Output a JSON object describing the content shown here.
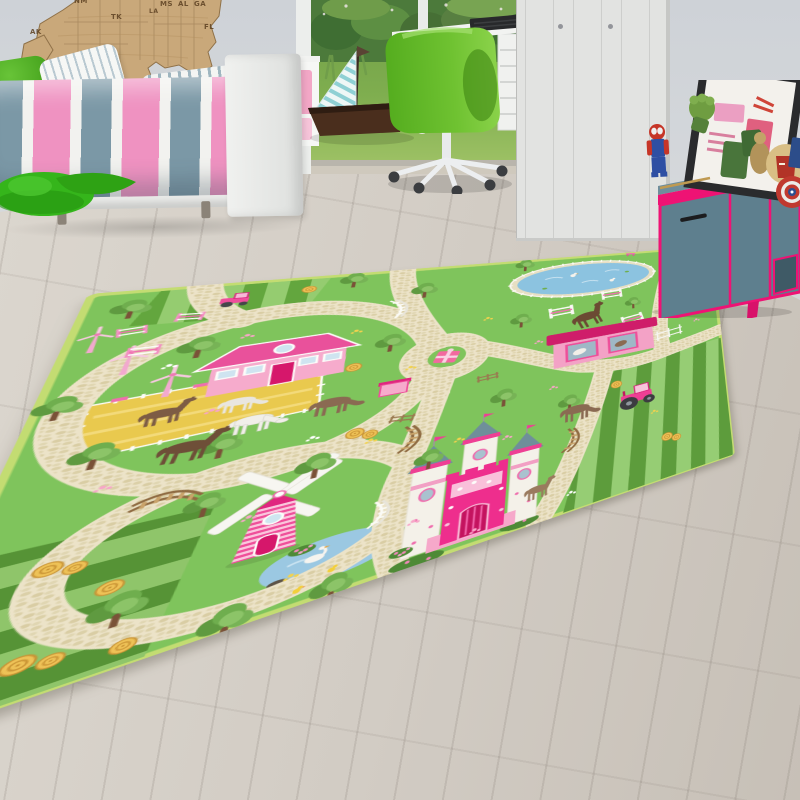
{
  "scene": {
    "type": "product-photo",
    "setting": "children bedroom with wood floor",
    "subject": "green pony-farm play rug"
  },
  "wall_map": {
    "material": "wood",
    "labels": [
      "AK",
      "NM",
      "TK",
      "LA",
      "MS",
      "AL",
      "GA",
      "FL"
    ]
  },
  "palette": {
    "wall": "#d2d5d9",
    "floor_wood": "#d2ccc4",
    "rug_green": "#7fc45c",
    "road_cream": "#ece3c8",
    "accent_pink": "#ee2e8d",
    "hot_pink_trim": "#ee1374",
    "sideboard_teal": "#5e7f8e",
    "chair_green": "#6abc2e",
    "bedding_pink": "#ef92c1",
    "bedding_blue": "#7b98a6",
    "pond_blue": "#8cc3e0",
    "hay_yellow": "#eec257",
    "map_wood": "#c9a87a",
    "garden_grass": "#86b446"
  },
  "room": {
    "furniture": [
      "bed with striped bedding",
      "white wardrobe",
      "white desk with drawer unit",
      "green swivel chair",
      "teal sideboard with pink trim"
    ],
    "decor": [
      "wooden USA wall map",
      "green leaf beanbag",
      "toy sailboat",
      "framed poster",
      "garden doorway"
    ],
    "toys_on_sideboard": [
      "lego spiderman figure",
      "hulk fist",
      "green figures",
      "iron man helmet",
      "captain america shield",
      "blue box"
    ]
  },
  "rug": {
    "theme": "pony farm play town",
    "buildings": [
      "pink farmhouse",
      "pink castle",
      "pink horse stable",
      "pink windmill",
      "small pink hut"
    ],
    "animals": [
      "brown horses",
      "white horse",
      "swans",
      "ducks",
      "chicks"
    ],
    "features": [
      "cream pebble roads",
      "roundabout with gift box",
      "striped crop fields",
      "yellow paddock",
      "hay rolls",
      "two ponds",
      "arched bridges",
      "horse jumps",
      "pink wind turbines",
      "trees",
      "flower speckles",
      "pink tractors"
    ]
  }
}
